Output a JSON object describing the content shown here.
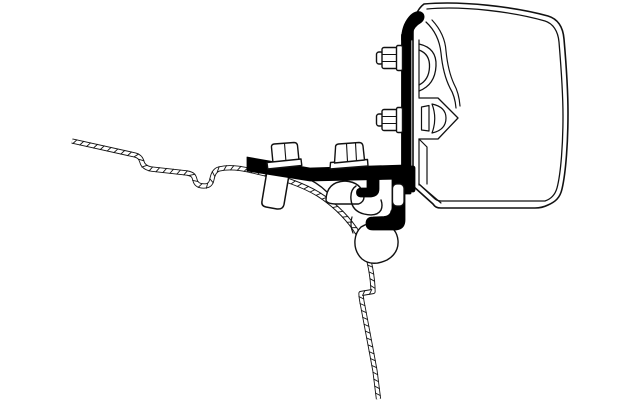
{
  "meta": {
    "title": "Technical line drawing of an awning mount adapter bracket on a vehicle roof profile",
    "canvas": {
      "width": 640,
      "height": 400,
      "background": "#ffffff"
    }
  },
  "palette": {
    "line": "#111111",
    "part_black": "#000000",
    "part_white": "#ffffff"
  },
  "diagram": {
    "parts": [
      {
        "name": "vehicle-roof-wall-profile",
        "kind": "hatched-band",
        "d": "M72,141 L135,155 C139,156 141,158 142,162 C143,166 146,168 151,169 L187,173 C193,174 194,176 195,180 C196,185 200,186 204,186 C209,186 211,184 212,179 C213,174 215,170 219,169 C229,166.5 240,168 253,171 C283,177.5 303,185 318,194 C333,203.5 345,215 355,229 C363,241 368,254 370.5,268 C372.5,279 373,287 373,291.5 L361,293.5 C361,297.5 362,302 363,307 C366,323 371,349 375,371 L378.5,399",
        "stroke": "#111111",
        "band": 5.2,
        "inner": 3.4,
        "tickSpacing": 7,
        "tickLen": 6.2,
        "tickAngle": 55
      },
      {
        "name": "roof-rail-edge-line",
        "kind": "path",
        "d": "M302,176 Q317,182 327,192 Q331,197 331,201",
        "fill": "none",
        "stroke": "#111111",
        "sw": 1.4
      },
      {
        "name": "roof-rail-hump",
        "kind": "path",
        "d": "M326,200 Q326.5,182 345,181 Q362,182 364,197 Q364,202 358.5,204 L335,204 Q326.5,203.5 326,200 Z",
        "fill": "#ffffff",
        "stroke": "#111111",
        "sw": 1.4
      },
      {
        "name": "roof-rail-channel",
        "kind": "path",
        "d": "M356,186 Q350,190 351,199.5 Q352,211 364,214 Q377,217 381,210 Q383,205.5 381,200",
        "fill": "none",
        "stroke": "#111111",
        "sw": 1.4
      },
      {
        "name": "roof-rail-lip-line",
        "kind": "path",
        "d": "M352,217 Q349.5,225 353,233",
        "fill": "none",
        "stroke": "#111111",
        "sw": 1.2
      },
      {
        "name": "roof-rail-foot",
        "kind": "path",
        "d": "M361,227 Q373,220 385,223.5 Q397,228.5 398,240.5 Q399,253 387,260 Q372,267 362,259 Q354,251.5 355,240 Q355.8,232 361,227 Z",
        "fill": "#ffffff",
        "stroke": "#111111",
        "sw": 1.4
      },
      {
        "name": "roof-rail-foot-tail",
        "kind": "path",
        "d": "M387,221.5 Q391,216.5 391,211",
        "fill": "none",
        "stroke": "#111111",
        "sw": 1.2
      },
      {
        "name": "bolt-sleeve",
        "kind": "path",
        "d": "M267,171 L289,175 L284,204.5 Q283,209.5 277,209 L266,207 Q261,206 262,201 Z",
        "fill": "#ffffff",
        "stroke": "#111111",
        "sw": 1.5
      },
      {
        "name": "awning-case-body",
        "kind": "path",
        "d": "M424,4 C462,0.5 516,7 548,16 C558,19 563,27 564,39 C566,62 568,92 568,113 C568,141 566,172 562,189 C560,198 555,202 548,205 C544,207 540,208 535,208 L441,208 C437,208 435,207 433,204 L413,186 L413,30 C413,20 417,9 424,4 Z",
        "fill": "#ffffff",
        "stroke": "#111111",
        "sw": 1.6
      },
      {
        "name": "awning-case-inner-line",
        "kind": "path",
        "d": "M427,9 C463,5.5 514,12 545,21 C553,23.5 558,31 559,42 C561,66 563,95 563,116 C563,143 561,173 557,188 C555,195 551,199 545,201 L441,201 C438,201 436,200 434,198 L419,184",
        "fill": "none",
        "stroke": "#111111",
        "sw": 1.3
      },
      {
        "name": "case-rail-base-lines",
        "kind": "path",
        "d": "M419,40 L419,97 M419,139 L419,185",
        "fill": "none",
        "stroke": "#111111",
        "sw": 1.2
      },
      {
        "name": "case-upper-channel",
        "kind": "path",
        "d": "M419,44 Q437,48 436,66 Q435,85 419,91 M419,50 Q430,54 429.5,67 Q429,80 419,85",
        "fill": "none",
        "stroke": "#111111",
        "sw": 1.3
      },
      {
        "name": "case-lower-channel",
        "kind": "path",
        "d": "M419,98 L438,98 L458,118 L438,139 L419,139",
        "fill": "#ffffff",
        "stroke": "#111111",
        "sw": 1.3
      },
      {
        "name": "case-channel-slot",
        "kind": "path",
        "d": "M421.5,107 L429,105.5 L429,131 L421.5,130 Z",
        "fill": "#ffffff",
        "stroke": "#111111",
        "sw": 1.2
      },
      {
        "name": "case-channel-wedge",
        "kind": "path",
        "d": "M432,104 Q446,107 446,118 Q446,130 432,133 Q437.5,118.5 432,104 Z",
        "fill": "#ffffff",
        "stroke": "#111111",
        "sw": 1.2
      },
      {
        "name": "case-inner-wall-lines",
        "kind": "path",
        "d": "M426,22 Q439,34 441,53 Q443,74 450,88 Q455,96 456,108 M432,20 Q445,34 446,51 Q448,71 454,84 Q459,93 460,106",
        "fill": "none",
        "stroke": "#111111",
        "sw": 1.2
      },
      {
        "name": "case-lower-wall-line",
        "kind": "path",
        "d": "M419,139 L427,147 L427,184",
        "fill": "none",
        "stroke": "#111111",
        "sw": 1.2
      },
      {
        "name": "case-chamfer-line",
        "kind": "path",
        "d": "M420,185 L441,203",
        "fill": "none",
        "stroke": "#111111",
        "sw": 1.2
      },
      {
        "name": "adapter-plate",
        "kind": "rect",
        "x": 401.5,
        "y": 34,
        "w": 9.5,
        "h": 160,
        "rx": 1,
        "fill": "#000000",
        "stroke": "#000000",
        "sw": 0.8
      },
      {
        "name": "plate-top-hook",
        "kind": "path",
        "d": "M401.5,40 C401.5,30 404,23 409,17 C413,12 419,10 422.5,13 C425,15.5 424.5,20 421,22.5 C416.5,25 413.5,28.5 412.5,33 L412.5,40 Z",
        "fill": "#000000",
        "stroke": "#000000",
        "sw": 0.8
      },
      {
        "name": "mounting-arm",
        "kind": "path",
        "d": "M247,157 L310,168 L404,165 L404,179 L310,181 L247,171 Z",
        "fill": "#000000",
        "stroke": "#000000",
        "sw": 0.8
      },
      {
        "name": "arm-plate-junction",
        "kind": "rect",
        "x": 399,
        "y": 166,
        "w": 16,
        "h": 26,
        "rx": 2,
        "fill": "#000000",
        "stroke": "#000000",
        "sw": 0.8
      },
      {
        "name": "rail-hook",
        "kind": "path",
        "d": "M392,178 L405,178 L405,220 Q405,229 396,230 L373,230 Q366,230 366,223.5 Q366,217 373,217 L384,216.5 Q391,216 392,208 Z",
        "fill": "#000000",
        "stroke": "#000000",
        "sw": 0.8
      },
      {
        "name": "rail-tab",
        "kind": "path",
        "d": "M367,178 L379,178 L379,189 Q379,196 371,197 L362,197 Q356.5,197 356.5,192.5 Q356.5,188 362,188 L367,188 Z",
        "fill": "#000000",
        "stroke": "#000000",
        "sw": 0.8
      },
      {
        "name": "plate-nut-upper-stub",
        "kind": "rect",
        "x": 376.5,
        "y": 52,
        "w": 6.5,
        "h": 12,
        "rx": 2.5,
        "fill": "#ffffff",
        "stroke": "#111111",
        "sw": 1.4
      },
      {
        "name": "plate-nut-upper-hex",
        "kind": "rect",
        "x": 382,
        "y": 47.5,
        "w": 15.5,
        "h": 21,
        "rx": 2,
        "fill": "#ffffff",
        "stroke": "#111111",
        "sw": 1.4
      },
      {
        "name": "plate-nut-upper-facets",
        "kind": "path",
        "d": "M382,54.5 L397.5,54.5 M382,61.5 L397.5,61.5",
        "fill": "none",
        "stroke": "#111111",
        "sw": 1.1
      },
      {
        "name": "plate-nut-upper-flange",
        "kind": "rect",
        "x": 396.5,
        "y": 45.5,
        "w": 6,
        "h": 25,
        "rx": 1.5,
        "fill": "#ffffff",
        "stroke": "#111111",
        "sw": 1.4
      },
      {
        "name": "plate-nut-lower-stub",
        "kind": "rect",
        "x": 376.5,
        "y": 114,
        "w": 6.5,
        "h": 12,
        "rx": 2.5,
        "fill": "#ffffff",
        "stroke": "#111111",
        "sw": 1.4
      },
      {
        "name": "plate-nut-lower-hex",
        "kind": "rect",
        "x": 382,
        "y": 109.5,
        "w": 15.5,
        "h": 21,
        "rx": 2,
        "fill": "#ffffff",
        "stroke": "#111111",
        "sw": 1.4
      },
      {
        "name": "plate-nut-lower-facets",
        "kind": "path",
        "d": "M382,116.5 L397.5,116.5 M382,123.5 L397.5,123.5",
        "fill": "none",
        "stroke": "#111111",
        "sw": 1.1
      },
      {
        "name": "plate-nut-lower-flange",
        "kind": "rect",
        "x": 396.5,
        "y": 107.5,
        "w": 6,
        "h": 25,
        "rx": 1.5,
        "fill": "#ffffff",
        "stroke": "#111111",
        "sw": 1.4
      },
      {
        "name": "arm-flange-nut-base",
        "kind": "path",
        "d": "M330,169 L368,166 L367.5,159.5 L330.5,162.5 Z",
        "fill": "#ffffff",
        "stroke": "#111111",
        "sw": 1.4
      },
      {
        "name": "arm-flange-nut-hex",
        "kind": "path",
        "d": "M335.5,148 Q335,144.5 338.5,144 L359,142.5 Q362.5,142.5 363,146 L364.5,160 L334.5,163 Z",
        "fill": "#ffffff",
        "stroke": "#111111",
        "sw": 1.4
      },
      {
        "name": "arm-flange-nut-facets",
        "kind": "path",
        "d": "M346.5,143.5 L347.5,161.5 M355.5,143 L356.5,161",
        "fill": "none",
        "stroke": "#111111",
        "sw": 1.1
      },
      {
        "name": "roof-bolt-head",
        "kind": "path",
        "d": "M271.5,147.5 Q271,144.5 274,144 L294,142.5 Q297,142.5 297.5,145.5 L299,160.5 L273,163 Z",
        "fill": "#ffffff",
        "stroke": "#111111",
        "sw": 1.4
      },
      {
        "name": "roof-bolt-head-facet",
        "kind": "path",
        "d": "M284.5,143.5 L286,162",
        "fill": "none",
        "stroke": "#111111",
        "sw": 1.1
      },
      {
        "name": "roof-bolt-washer",
        "kind": "path",
        "d": "M267,162.5 L301,159 L301.8,165.5 L267.8,169 Z",
        "fill": "#ffffff",
        "stroke": "#111111",
        "sw": 1.4
      },
      {
        "name": "rail-lip",
        "kind": "rect",
        "x": 392.5,
        "y": 184,
        "w": 11.5,
        "h": 22,
        "rx": 4.5,
        "fill": "#ffffff",
        "stroke": "#111111",
        "sw": 1.3
      }
    ]
  }
}
